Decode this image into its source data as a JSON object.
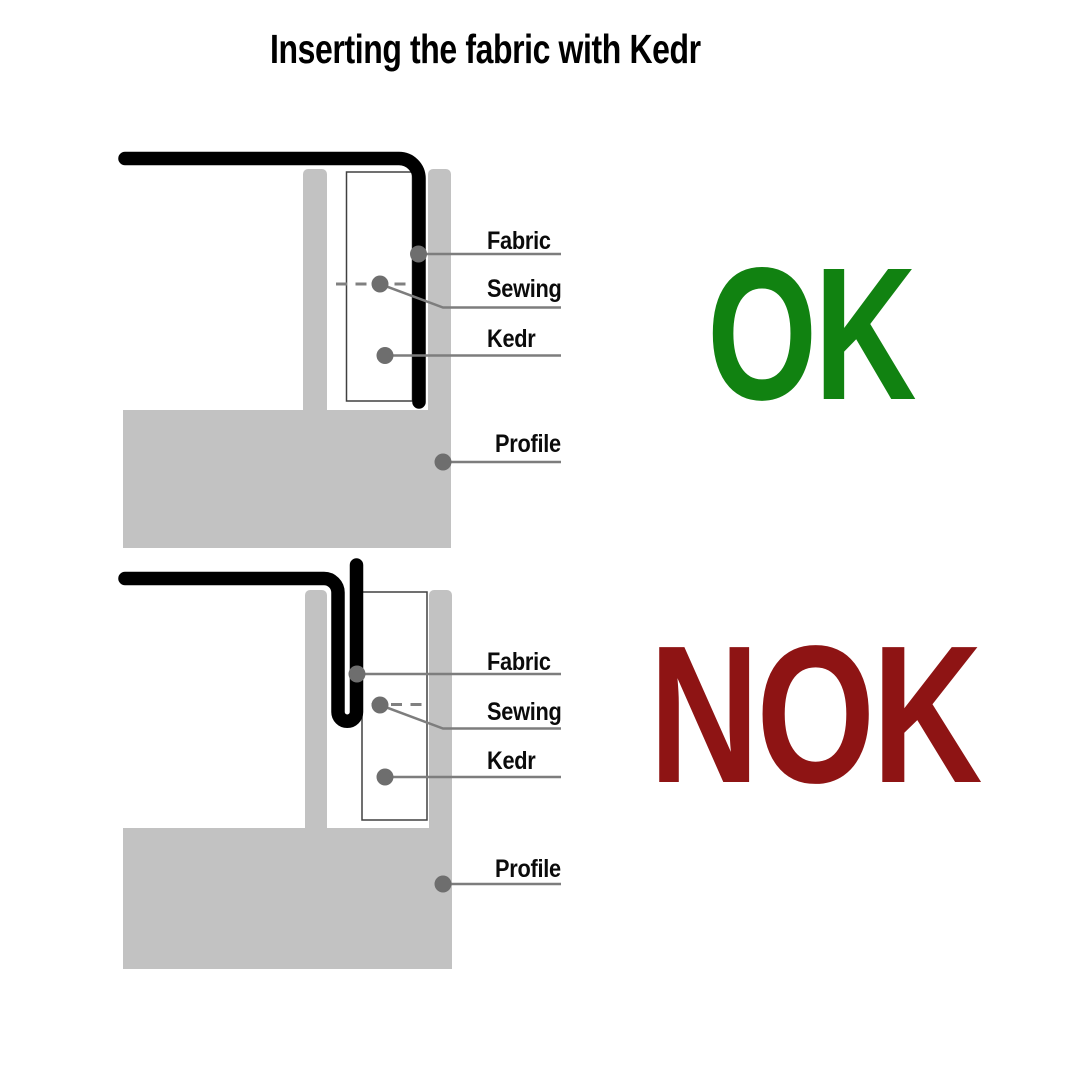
{
  "title": "Inserting the fabric with Kedr",
  "colors": {
    "ok_green": "#118211",
    "nok_red": "#8e1414",
    "profile_gray": "#c2c2c2",
    "fabric_black": "#000000",
    "leader_gray": "#7d7d7d",
    "dot_gray": "#6e6e6e"
  },
  "diagrams": [
    {
      "status": "OK",
      "labels": {
        "fabric": "Fabric",
        "sewing": "Sewing",
        "kedr": "Kedr",
        "profile": "Profile"
      }
    },
    {
      "status": "NOK",
      "labels": {
        "fabric": "Fabric",
        "sewing": "Sewing",
        "kedr": "Kedr",
        "profile": "Profile"
      }
    }
  ]
}
